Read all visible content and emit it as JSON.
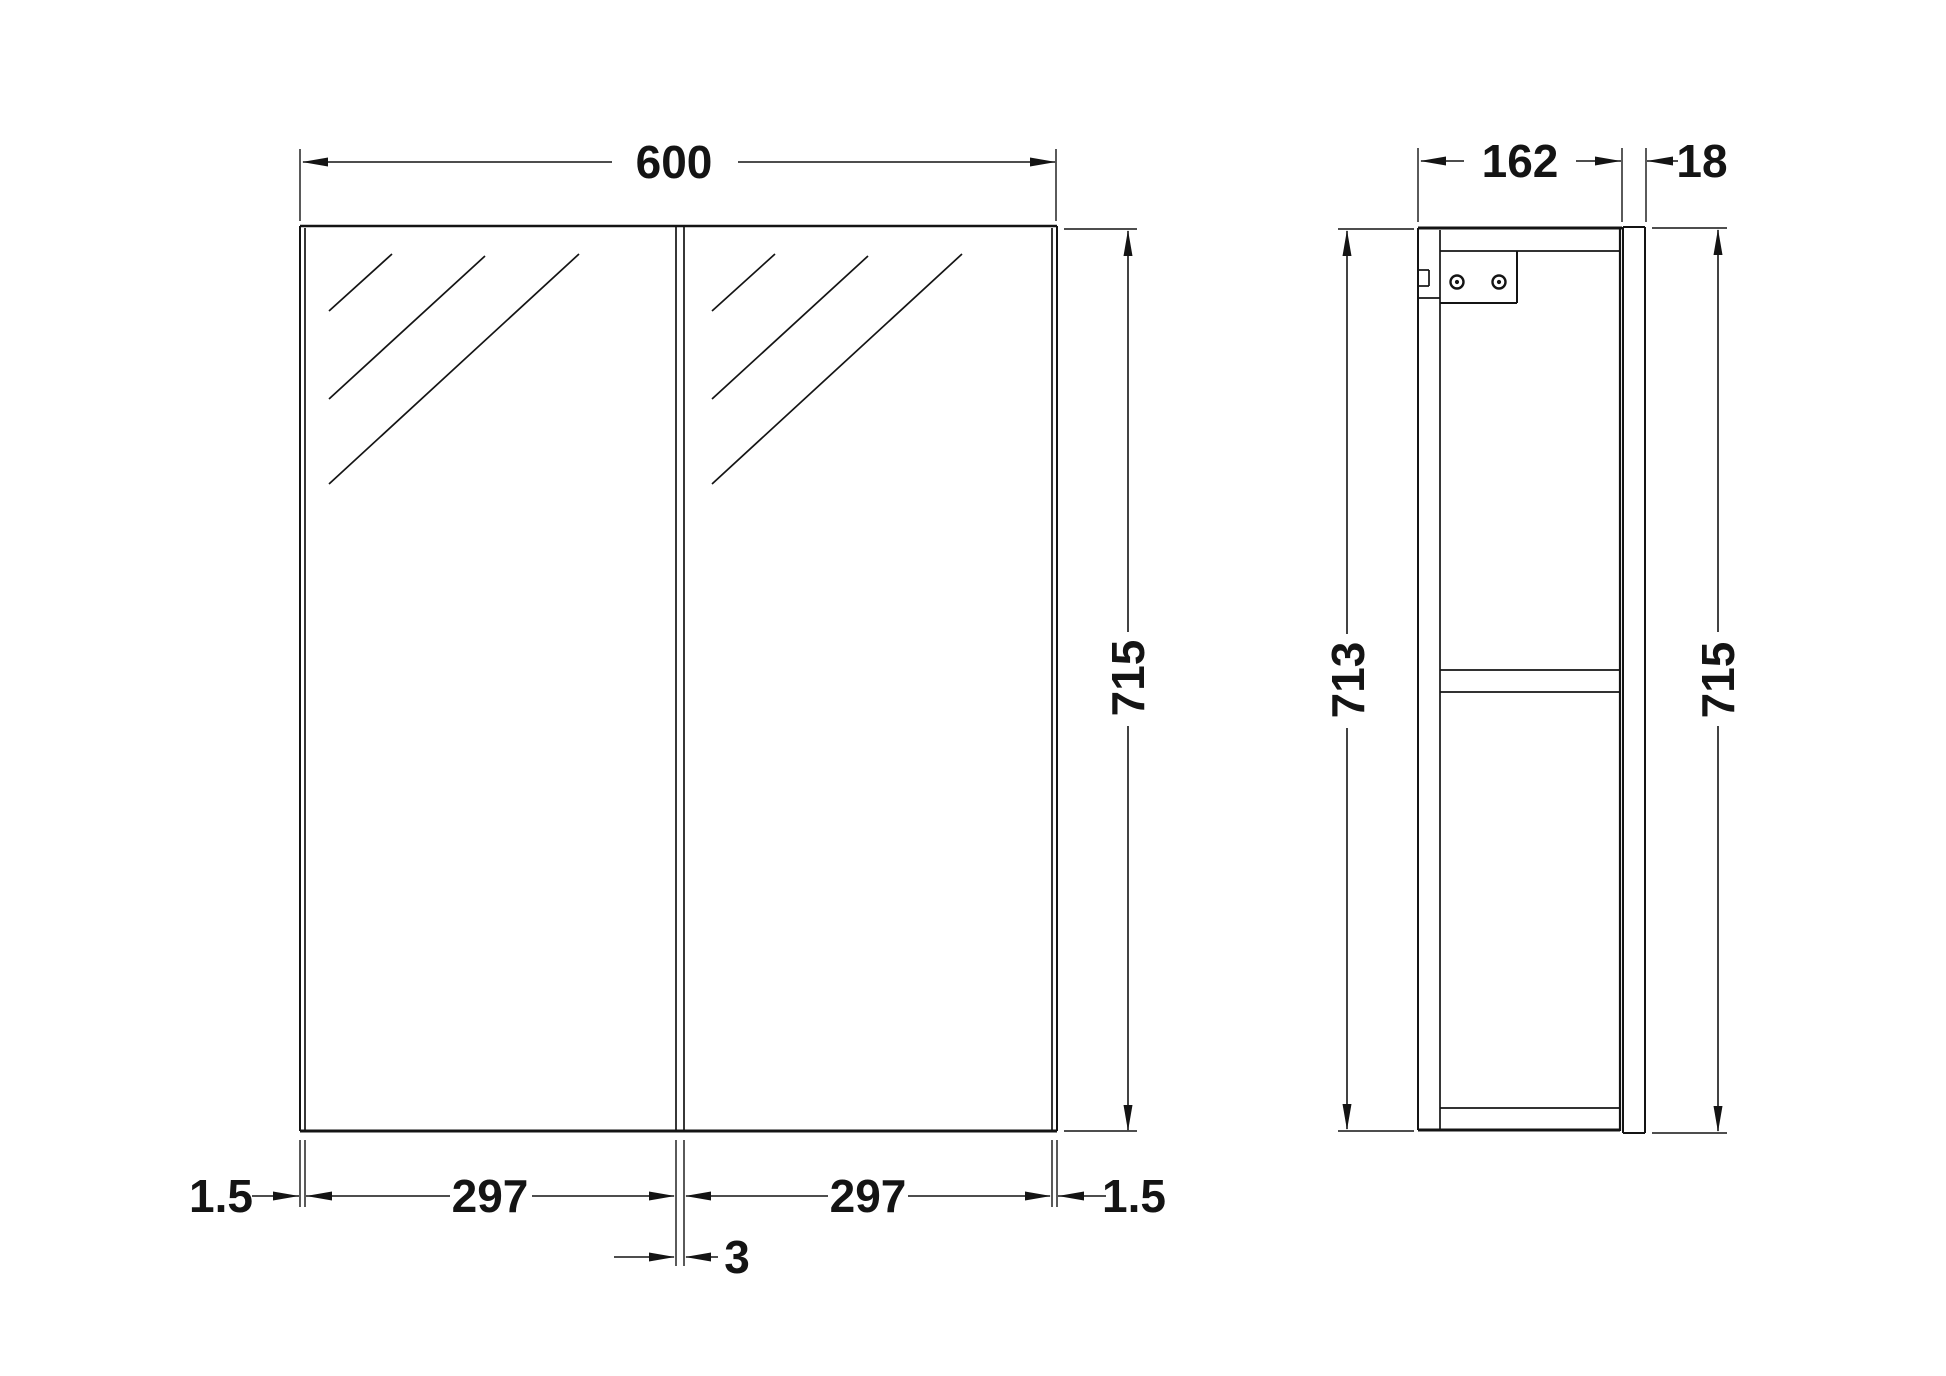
{
  "drawing": {
    "width": 1946,
    "height": 1376,
    "ink": "#141414",
    "background": "#ffffff",
    "label_font_size": 46
  },
  "dimensions": {
    "overall_width_mm": "600",
    "door_width_left_mm": "297",
    "door_width_right_mm": "297",
    "edge_gap_left_mm": "1.5",
    "edge_gap_right_mm": "1.5",
    "door_gap_mm": "3",
    "door_height_mm": "715",
    "carcass_height_mm": "713",
    "side_height_mm": "715",
    "carcass_depth_mm": "162",
    "door_thickness_mm": "18"
  },
  "geometry": {
    "labels": [
      [
        "dim-600-label",
        "600",
        674,
        162,
        0
      ],
      [
        "dim-162-label",
        "162",
        1520,
        161,
        0
      ],
      [
        "dim-18-label",
        "18",
        1702,
        161,
        0
      ],
      [
        "dim-715-front-label",
        "715",
        1128,
        678,
        -90
      ],
      [
        "dim-713-label",
        "713",
        1348,
        680,
        -90
      ],
      [
        "dim-715-side-label",
        "715",
        1718,
        680,
        -90
      ],
      [
        "dim-1-5-left-label",
        "1.5",
        221,
        1196,
        0
      ],
      [
        "dim-297-left-label",
        "297",
        490,
        1196,
        0
      ],
      [
        "dim-297-right-label",
        "297",
        868,
        1196,
        0
      ],
      [
        "dim-1-5-right-label",
        "1.5",
        1134,
        1196,
        0
      ],
      [
        "dim-3-label",
        "3",
        737,
        1257,
        0
      ]
    ],
    "lines": [
      [
        "front-top-edge",
        300,
        226,
        1057,
        226,
        2.5
      ],
      [
        "front-left-edge",
        300,
        226,
        300,
        1131,
        2
      ],
      [
        "front-right-edge",
        1057,
        226,
        1057,
        1131,
        2
      ],
      [
        "front-bottom-edge",
        300,
        1131,
        1057,
        1131,
        3
      ],
      [
        "front-left-door-edge",
        305,
        228,
        305,
        1131,
        1.7
      ],
      [
        "front-right-door-edge",
        1052,
        228,
        1052,
        1131,
        1.7
      ],
      [
        "front-center-gap-left",
        676,
        227,
        676,
        1131,
        1.7
      ],
      [
        "front-center-gap-right",
        684,
        227,
        684,
        1131,
        1.7
      ],
      [
        "left-door-hatch-1",
        329,
        311,
        392,
        254,
        1.7
      ],
      [
        "left-door-hatch-2",
        329,
        399,
        485,
        256,
        1.7
      ],
      [
        "left-door-hatch-3",
        329,
        484,
        579,
        254,
        1.7
      ],
      [
        "right-door-hatch-1",
        712,
        311,
        775,
        254,
        1.7
      ],
      [
        "right-door-hatch-2",
        712,
        399,
        868,
        256,
        1.7
      ],
      [
        "right-door-hatch-3",
        712,
        484,
        962,
        254,
        1.7
      ],
      [
        "ext-600-left",
        300,
        149,
        300,
        221,
        1.4
      ],
      [
        "ext-600-right",
        1056,
        149,
        1056,
        221,
        1.4
      ],
      [
        "dim-600-line-a",
        303,
        162,
        612,
        162,
        1.6
      ],
      [
        "dim-600-line-b",
        738,
        162,
        1055,
        162,
        1.6
      ],
      [
        "ref-715-front-top",
        1064,
        229,
        1137,
        229,
        1.6
      ],
      [
        "ref-715-front-bottom",
        1064,
        1131,
        1137,
        1131,
        1.6
      ],
      [
        "dim-715-front-line-a",
        1128,
        231,
        1128,
        632,
        1.6
      ],
      [
        "dim-715-front-line-b",
        1128,
        726,
        1128,
        1130,
        1.6
      ],
      [
        "ext-bottom-left-outer",
        300,
        1140,
        300,
        1207,
        1.4
      ],
      [
        "ext-bottom-left-inner",
        305,
        1140,
        305,
        1207,
        1.4
      ],
      [
        "ext-bottom-center-left",
        676,
        1140,
        676,
        1266,
        1.4
      ],
      [
        "ext-bottom-center-right",
        684,
        1140,
        684,
        1266,
        1.4
      ],
      [
        "ext-bottom-right-inner",
        1052,
        1140,
        1052,
        1207,
        1.4
      ],
      [
        "ext-bottom-right-outer",
        1057,
        1140,
        1057,
        1207,
        1.4
      ],
      [
        "dim-1-5-left-line",
        252,
        1196,
        299,
        1196,
        1.6
      ],
      [
        "dim-297-left-line-a",
        306,
        1196,
        450,
        1196,
        1.6
      ],
      [
        "dim-297-left-line-b",
        532,
        1196,
        674,
        1196,
        1.6
      ],
      [
        "dim-297-right-line-a",
        686,
        1196,
        828,
        1196,
        1.6
      ],
      [
        "dim-297-right-line-b",
        908,
        1196,
        1050,
        1196,
        1.6
      ],
      [
        "dim-1-5-right-line",
        1058,
        1196,
        1106,
        1196,
        1.6
      ],
      [
        "dim-3-line-a",
        614,
        1257,
        674,
        1257,
        1.6
      ],
      [
        "dim-3-line-b",
        686,
        1257,
        718,
        1257,
        1.6
      ],
      [
        "side-top-edge",
        1418,
        228,
        1622,
        228,
        3
      ],
      [
        "side-back-outer",
        1418,
        228,
        1418,
        1130,
        2
      ],
      [
        "side-back-inner",
        1440,
        230,
        1440,
        1130,
        1.7
      ],
      [
        "side-top-panel-bottom",
        1440,
        251,
        1620,
        251,
        1.7
      ],
      [
        "side-front-edge",
        1620,
        228,
        1620,
        1131,
        2.2
      ],
      [
        "side-shelf-top",
        1440,
        670,
        1620,
        670,
        1.7
      ],
      [
        "side-shelf-bottom",
        1440,
        692,
        1620,
        692,
        1.7
      ],
      [
        "side-bottom-panel-top",
        1440,
        1108,
        1620,
        1108,
        1.7
      ],
      [
        "side-bottom-edge",
        1418,
        1130,
        1620,
        1130,
        3
      ],
      [
        "bracket-right-edge",
        1517,
        251,
        1517,
        303,
        2
      ],
      [
        "bracket-bottom-edge",
        1440,
        303,
        1517,
        303,
        2
      ],
      [
        "hanging-notch-top",
        1419,
        270,
        1429,
        270,
        1.7
      ],
      [
        "hanging-notch-vertical",
        1429,
        270,
        1429,
        286,
        1.7
      ],
      [
        "hanging-notch-bottom",
        1419,
        286,
        1429,
        286,
        1.7
      ],
      [
        "back-panel-joint",
        1418,
        298,
        1440,
        298,
        1.7
      ],
      [
        "mirror-door-left",
        1623,
        227,
        1623,
        1133,
        2
      ],
      [
        "mirror-door-right",
        1645,
        227,
        1645,
        1133,
        2
      ],
      [
        "mirror-door-top",
        1623,
        227,
        1645,
        227,
        2
      ],
      [
        "mirror-door-bottom",
        1623,
        1133,
        1645,
        1133,
        2
      ],
      [
        "ext-162-left",
        1418,
        148,
        1418,
        222,
        1.4
      ],
      [
        "ext-162-right",
        1622,
        148,
        1622,
        222,
        1.4
      ],
      [
        "dim-162-line-a",
        1421,
        161,
        1464,
        161,
        1.6
      ],
      [
        "dim-162-line-b",
        1576,
        161,
        1621,
        161,
        1.6
      ],
      [
        "ext-18-right",
        1646,
        148,
        1646,
        222,
        1.4
      ],
      [
        "dim-18-line",
        1647,
        161,
        1678,
        161,
        1.6
      ],
      [
        "ref-713-top",
        1338,
        229,
        1414,
        229,
        1.6
      ],
      [
        "ref-713-bottom",
        1338,
        1131,
        1414,
        1131,
        1.6
      ],
      [
        "dim-713-line-a",
        1347,
        231,
        1347,
        634,
        1.6
      ],
      [
        "dim-713-line-b",
        1347,
        728,
        1347,
        1129,
        1.6
      ],
      [
        "ref-715-side-top",
        1652,
        228,
        1727,
        228,
        1.6
      ],
      [
        "ref-715-side-bottom",
        1652,
        1133,
        1727,
        1133,
        1.6
      ],
      [
        "dim-715-side-line-a",
        1718,
        230,
        1718,
        632,
        1.6
      ],
      [
        "dim-715-side-line-b",
        1718,
        726,
        1718,
        1131,
        1.6
      ]
    ],
    "arrows": [
      [
        "arrow-600-left",
        "left",
        302,
        162
      ],
      [
        "arrow-600-right",
        "right",
        1056,
        162
      ],
      [
        "arrow-715-front-up",
        "up",
        1128,
        230
      ],
      [
        "arrow-715-front-down",
        "down",
        1128,
        1131
      ],
      [
        "arrow-1-5-left",
        "right",
        299,
        1196
      ],
      [
        "arrow-297-left-start",
        "left",
        306,
        1196
      ],
      [
        "arrow-297-left-end",
        "right",
        675,
        1196
      ],
      [
        "arrow-297-right-start",
        "left",
        685,
        1196
      ],
      [
        "arrow-297-right-end",
        "right",
        1051,
        1196
      ],
      [
        "arrow-1-5-right",
        "left",
        1058,
        1196
      ],
      [
        "arrow-3-left",
        "right",
        675,
        1257
      ],
      [
        "arrow-3-right",
        "left",
        685,
        1257
      ],
      [
        "arrow-162-left",
        "left",
        1420,
        161
      ],
      [
        "arrow-162-right",
        "right",
        1621,
        161
      ],
      [
        "arrow-18",
        "left",
        1647,
        161
      ],
      [
        "arrow-713-up",
        "up",
        1347,
        230
      ],
      [
        "arrow-713-down",
        "down",
        1347,
        1130
      ],
      [
        "arrow-715-side-up",
        "up",
        1718,
        229
      ],
      [
        "arrow-715-side-down",
        "down",
        1718,
        1132
      ]
    ],
    "circles": [
      [
        "bracket-screw-left",
        1457,
        282
      ],
      [
        "bracket-screw-right",
        1499,
        282
      ]
    ]
  }
}
